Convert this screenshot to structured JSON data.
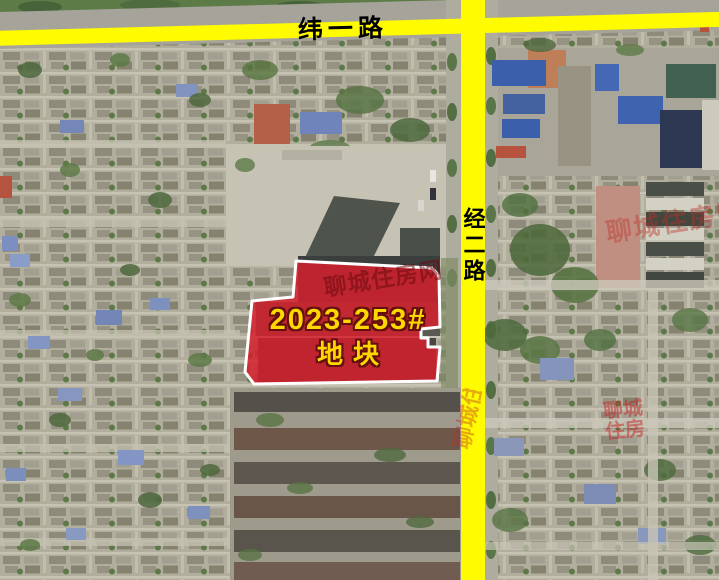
{
  "map": {
    "roads": [
      {
        "name": "纬一路",
        "orientation": "horizontal"
      },
      {
        "name": "经二路",
        "orientation": "vertical"
      }
    ],
    "parcel": {
      "label_line1": "2023-253#",
      "label_line2": "地块",
      "fill_color": "#d5202d",
      "border_color": "#ffffff",
      "label_color": "#ffd700",
      "label_outline_color": "#63100f"
    },
    "watermark": {
      "text": "聊城住房网"
    },
    "colors": {
      "road_fill": "#fffb00",
      "road_label": "#000000",
      "satellite_base": "#b2ae9e"
    }
  }
}
